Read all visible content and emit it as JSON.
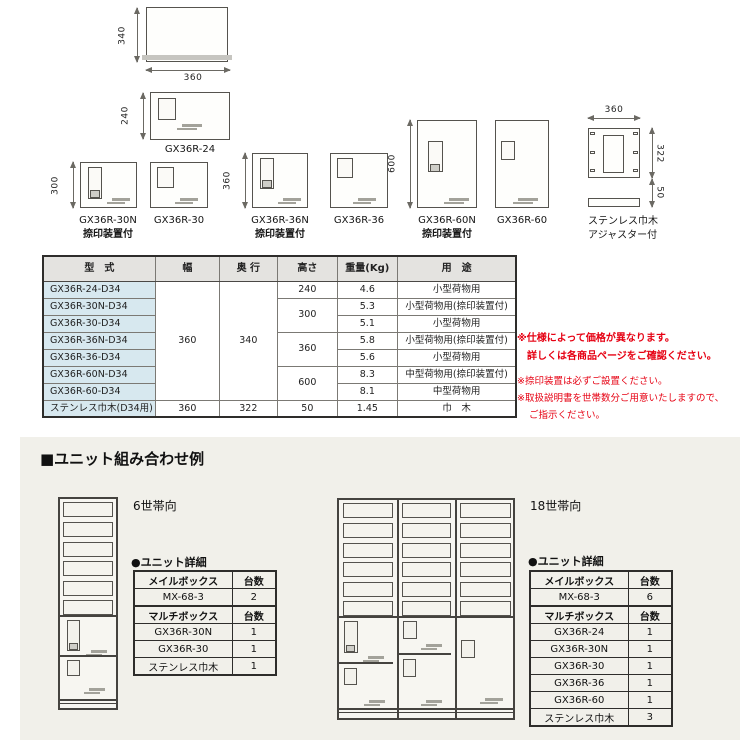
{
  "colors": {
    "accent_red": "#e60012",
    "panel_bg": "#f1f0ea",
    "spec_header_bg": "#e4e3e0",
    "model_col_bg": "#d7e8ef",
    "diagram_line": "#55534e"
  },
  "diagrams": {
    "top_view": {
      "dim_h": "340",
      "dim_w": "360"
    },
    "gx36r24": {
      "label": "GX36R-24",
      "dim": "240"
    },
    "gx36r30n": {
      "label": "GX36R-30N",
      "sublabel": "捺印装置付",
      "dim": "300"
    },
    "gx36r30": {
      "label": "GX36R-30"
    },
    "gx36r36n": {
      "label": "GX36R-36N",
      "sublabel": "捺印装置付",
      "dim": "360"
    },
    "gx36r36": {
      "label": "GX36R-36"
    },
    "gx36r60n": {
      "label": "GX36R-60N",
      "sublabel": "捺印装置付",
      "dim": "600"
    },
    "gx36r60": {
      "label": "GX36R-60"
    },
    "stainless": {
      "label1": "ステンレス巾木",
      "label2": "アジャスター付",
      "dim_top": "360",
      "dim_right": "322",
      "dim_bottom": "50"
    }
  },
  "spec_table": {
    "headers": {
      "model": "型　式",
      "width": "幅",
      "depth": "奥 行",
      "height": "高さ",
      "weight": "重量(Kg)",
      "use": "用　途"
    },
    "shared": {
      "width": "360",
      "depth": "340",
      "h240": "240",
      "h300": "300",
      "h360": "360",
      "h600": "600"
    },
    "rows": [
      {
        "model": "GX36R-24-D34",
        "weight": "4.6",
        "use": "小型荷物用"
      },
      {
        "model": "GX36R-30N-D34",
        "weight": "5.3",
        "use": "小型荷物用(捺印装置付)"
      },
      {
        "model": "GX36R-30-D34",
        "weight": "5.1",
        "use": "小型荷物用"
      },
      {
        "model": "GX36R-36N-D34",
        "weight": "5.8",
        "use": "小型荷物用(捺印装置付)"
      },
      {
        "model": "GX36R-36-D34",
        "weight": "5.6",
        "use": "小型荷物用"
      },
      {
        "model": "GX36R-60N-D34",
        "weight": "8.3",
        "use": "中型荷物用(捺印装置付)"
      },
      {
        "model": "GX36R-60-D34",
        "weight": "8.1",
        "use": "中型荷物用"
      }
    ],
    "last_row": {
      "model": "ステンレス巾木(D34用)",
      "width": "360",
      "depth": "322",
      "height": "50",
      "weight": "1.45",
      "use": "巾　木"
    }
  },
  "notes": {
    "bold1": "※仕様によって価格が異なります。",
    "bold2": "詳しくは各商品ページをご確認ください。",
    "n1": "※捺印装置は必ずご設置ください。",
    "n2": "※取扱説明書を世帯数分ご用意いたしますので、",
    "n3": "ご指示ください。"
  },
  "combo": {
    "heading": "■ユニット組み合わせ例",
    "left": {
      "label": "6世帯向",
      "detail": "●ユニット詳細",
      "rows": [
        {
          "c1": "メイルボックス",
          "c2": "台数"
        },
        {
          "c1": "MX-68-3",
          "c2": "2"
        },
        {
          "c1": "マルチボックス",
          "c2": "台数"
        },
        {
          "c1": "GX36R-30N",
          "c2": "1"
        },
        {
          "c1": "GX36R-30",
          "c2": "1"
        },
        {
          "c1": "ステンレス巾木",
          "c2": "1"
        }
      ]
    },
    "right": {
      "label": "18世帯向",
      "detail": "●ユニット詳細",
      "rows": [
        {
          "c1": "メイルボックス",
          "c2": "台数"
        },
        {
          "c1": "MX-68-3",
          "c2": "6"
        },
        {
          "c1": "マルチボックス",
          "c2": "台数"
        },
        {
          "c1": "GX36R-24",
          "c2": "1"
        },
        {
          "c1": "GX36R-30N",
          "c2": "1"
        },
        {
          "c1": "GX36R-30",
          "c2": "1"
        },
        {
          "c1": "GX36R-36",
          "c2": "1"
        },
        {
          "c1": "GX36R-60",
          "c2": "1"
        },
        {
          "c1": "ステンレス巾木",
          "c2": "3"
        }
      ]
    }
  }
}
